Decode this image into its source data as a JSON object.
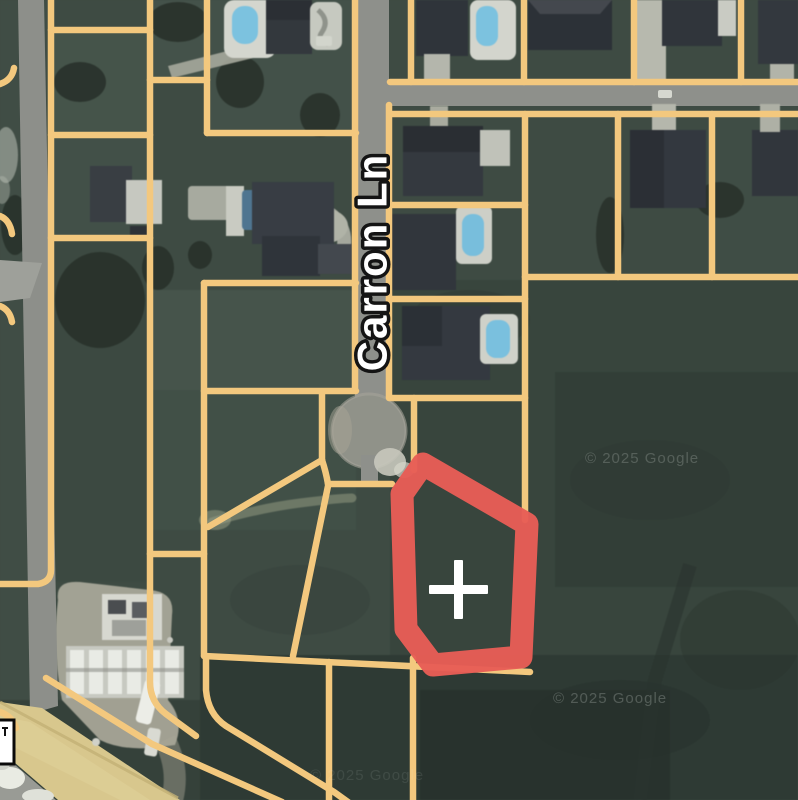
{
  "map": {
    "street_label": "Carron Ln",
    "marker": {
      "symbol": "+"
    },
    "watermarks": [
      "© 2025 Google",
      "© 2025 Google",
      "© 2025 Google"
    ],
    "colors": {
      "parcel_line": "#F3C87E",
      "highlight_outline": "#E75D56",
      "road_gray": "#8E908B",
      "major_road_tan": "#D8C78D",
      "marker_white": "#FFFFFF",
      "field_green": "#3E4B43",
      "pool_blue": "#7CC2DF"
    }
  }
}
